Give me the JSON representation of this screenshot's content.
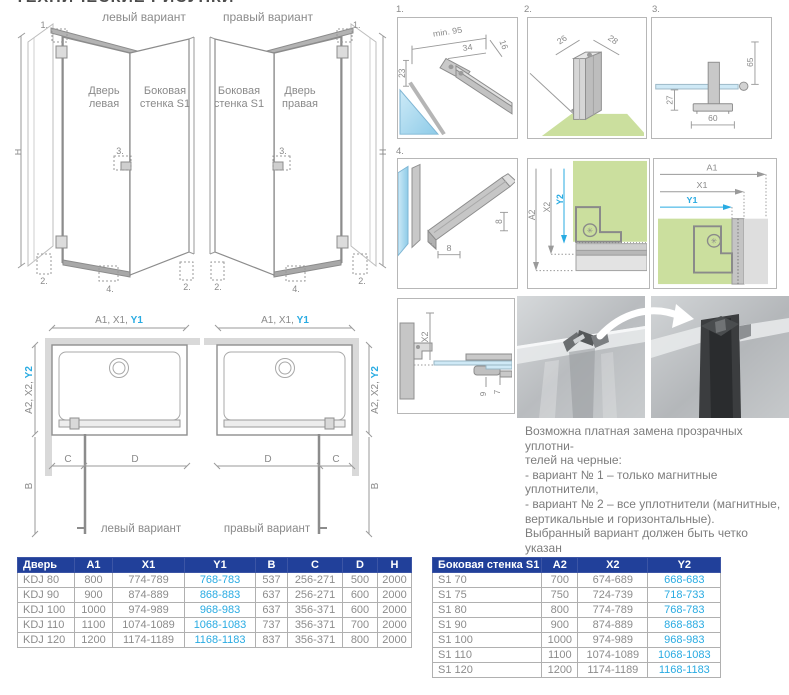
{
  "page": {
    "title": "ТЕХНИЧЕСКИЕ РИСУНКИ"
  },
  "colors": {
    "accent_blue": "#29abe2",
    "table_header_bg": "#21409a",
    "wall_green": "#cbdf9e",
    "glass_blue": "#a9d9ef"
  },
  "iso": {
    "left": {
      "variant": "левый вариант",
      "door1": "Дверь",
      "door2": "левая",
      "wall1": "Боковая",
      "wall2": "стенка S1",
      "h": "H",
      "m1": "1.",
      "m2a": "2.",
      "m2b": "2.",
      "m3": "3.",
      "m4": "4."
    },
    "right": {
      "variant": "правый вариант",
      "door1": "Дверь",
      "door2": "правая",
      "wall1": "Боковая",
      "wall2": "стенка S1",
      "h": "H",
      "m1": "1.",
      "m2a": "2.",
      "m2b": "2.",
      "m3": "3.",
      "m4": "4."
    }
  },
  "details": {
    "d1": {
      "num": "1.",
      "min": "min. 95",
      "a": "34",
      "b": "16",
      "c": "23"
    },
    "d2": {
      "num": "2.",
      "a": "26",
      "b": "28"
    },
    "d3": {
      "num": "3.",
      "a": "65",
      "b": "27",
      "c": "60"
    },
    "d4": {
      "num": "4.",
      "a": "8",
      "b": "8"
    },
    "d5": {
      "a": "A2",
      "b": "X2",
      "c": "Y2",
      "sym": "✳"
    },
    "d6": {
      "a": "A1",
      "b": "X1",
      "c": "Y1",
      "sym": "✳"
    },
    "d7": {
      "a": "X2",
      "b": "9",
      "c": "7"
    }
  },
  "plan": {
    "left": {
      "top": "A1, X1, ",
      "top_accent": "Y1",
      "side": "A2, X2, ",
      "side_accent": "Y2",
      "b": "B",
      "c": "C",
      "d": "D",
      "variant": "левый вариант"
    },
    "right": {
      "top": "A1, X1, ",
      "top_accent": "Y1",
      "side": "A2, X2, ",
      "side_accent": "Y2",
      "b": "B",
      "c": "C",
      "d": "D",
      "variant": "правый вариант"
    }
  },
  "note": {
    "lines": [
      "Возможна платная замена прозрачных уплотни-",
      "телей на черные:",
      "- вариант № 1 – только магнитные уплотнители,",
      "- вариант № 2 – все уплотнители (магнитные,",
      "вертикальные и горизонтальные).",
      "Выбранный вариант должен быть четко указан",
      "в заказе."
    ]
  },
  "door_table": {
    "headers": [
      "Дверь",
      "A1",
      "X1",
      "Y1",
      "B",
      "C",
      "D",
      "H"
    ],
    "accent_col": 3,
    "rows": [
      [
        "KDJ 80",
        "800",
        "774-789",
        "768-783",
        "537",
        "256-271",
        "500",
        "2000"
      ],
      [
        "KDJ 90",
        "900",
        "874-889",
        "868-883",
        "637",
        "256-271",
        "600",
        "2000"
      ],
      [
        "KDJ 100",
        "1000",
        "974-989",
        "968-983",
        "637",
        "356-371",
        "600",
        "2000"
      ],
      [
        "KDJ 110",
        "1100",
        "1074-1089",
        "1068-1083",
        "737",
        "356-371",
        "700",
        "2000"
      ],
      [
        "KDJ 120",
        "1200",
        "1174-1189",
        "1168-1183",
        "837",
        "356-371",
        "800",
        "2000"
      ]
    ]
  },
  "side_table": {
    "headers": [
      "Боковая стенка S1",
      "A2",
      "X2",
      "Y2"
    ],
    "accent_col": 3,
    "rows": [
      [
        "S1 70",
        "700",
        "674-689",
        "668-683"
      ],
      [
        "S1 75",
        "750",
        "724-739",
        "718-733"
      ],
      [
        "S1 80",
        "800",
        "774-789",
        "768-783"
      ],
      [
        "S1 90",
        "900",
        "874-889",
        "868-883"
      ],
      [
        "S1 100",
        "1000",
        "974-989",
        "968-983"
      ],
      [
        "S1 110",
        "1100",
        "1074-1089",
        "1068-1083"
      ],
      [
        "S1 120",
        "1200",
        "1174-1189",
        "1168-1183"
      ]
    ]
  }
}
